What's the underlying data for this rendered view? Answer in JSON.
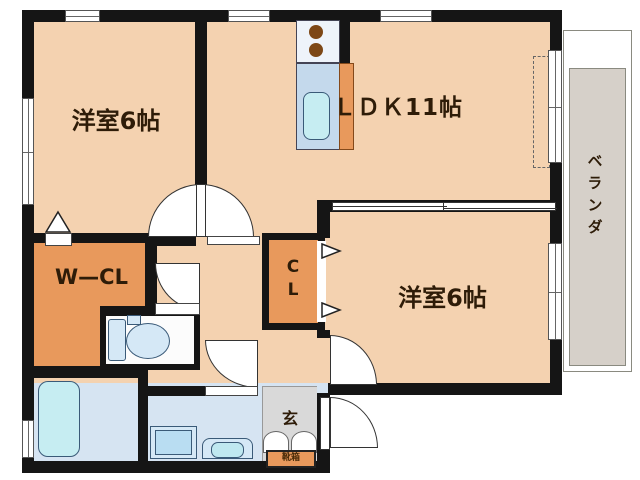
{
  "floorplan": {
    "rooms": {
      "bedroom_top_left": "洋室6帖",
      "ldk": "ＬＤＫ11帖",
      "bedroom_bottom_right": "洋室6帖",
      "walk_in_closet": "W—CL",
      "closet_c": "C",
      "closet_l": "L",
      "veranda": "ベランダ",
      "entrance": "玄",
      "shoe_cabinet": "靴箱"
    },
    "colors": {
      "wall": "#151515",
      "room_floor": "#f4d2b0",
      "closet_orange": "#e8995c",
      "wet_floor": "#d6e4f2",
      "fixture_fill": "#d5e8f6",
      "fixture_line": "#3a5a78",
      "tub_cyan": "#c6edf2",
      "counter_blue": "#c4d9ec",
      "stove_white": "#eef3fa",
      "burner_brown": "#7d4716",
      "veranda_grey": "#d6d0c9",
      "entrance_grey": "#d9d9d9",
      "label_color": "#2e1c08"
    }
  }
}
